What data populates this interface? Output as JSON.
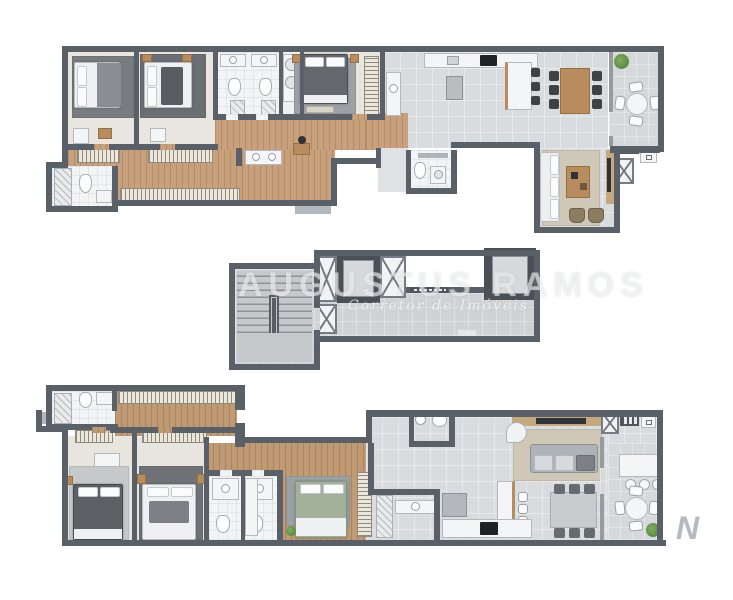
{
  "watermark": {
    "title": "AUGUSTUS RAMOS",
    "subtitle": "Corretor de Imóveis",
    "logo_letter": "N"
  },
  "colors": {
    "wall": "#5a6067",
    "wall2": "#959ba1",
    "tile": "#d9dcde",
    "tile2": "#dfe2e4",
    "wood": "#c8a17c",
    "wood2": "#c09a72",
    "bath": "#f2f4f5",
    "balc": "#d6d9db",
    "core": "#d0d3d5",
    "fixture": "#f4f5f6",
    "wfurn": "#b98c5f",
    "chair": "#3e4247",
    "chairg": "#666b70",
    "plant1": "#7fae5e",
    "plant2": "#4e7a38"
  }
}
